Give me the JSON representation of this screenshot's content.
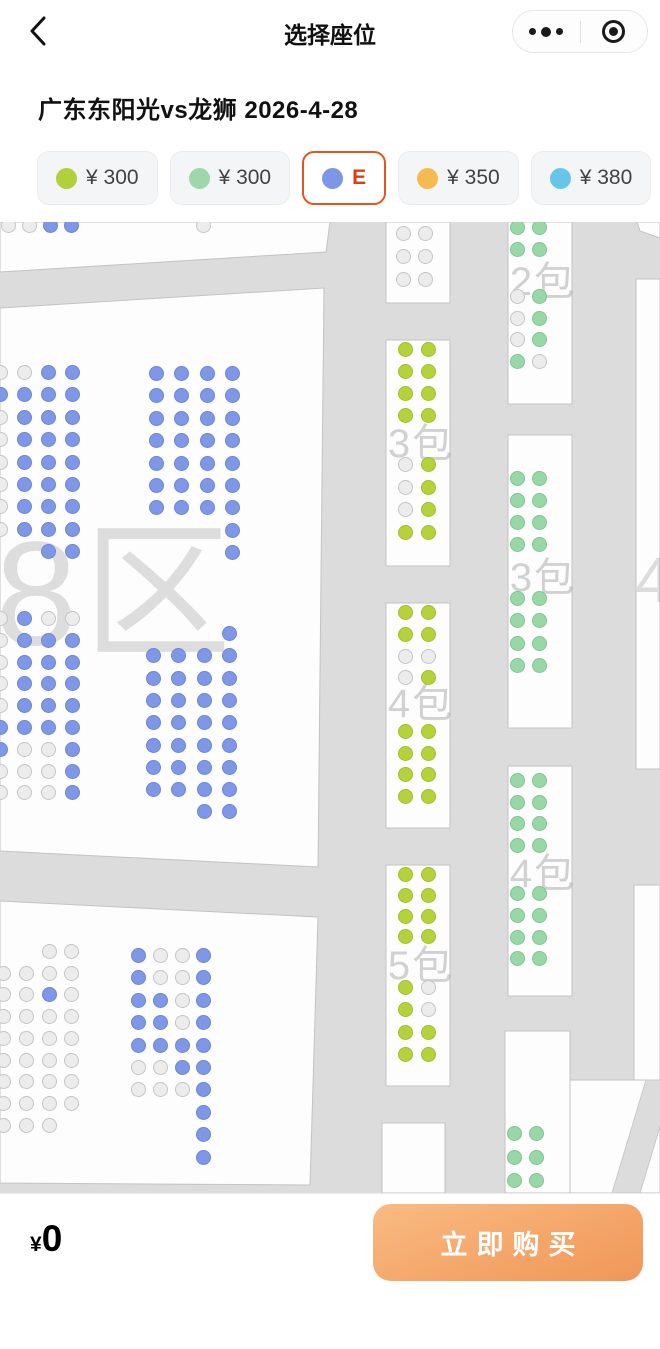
{
  "nav": {
    "title": "选择座位",
    "back_icon": "chevron-left",
    "menu_icon": "more-dots",
    "home_icon": "target-circle"
  },
  "event": {
    "title": "广东东阳光vs龙狮 2026-4-28"
  },
  "filters": {
    "chips": [
      {
        "label": "¥ 300",
        "color": "#b2d03a",
        "selected": false
      },
      {
        "label": "¥ 300",
        "color": "#9ed8aa",
        "selected": false
      },
      {
        "label": "E",
        "color": "#7d97e8",
        "selected": true
      },
      {
        "label": "¥ 350",
        "color": "#f6bb4e",
        "selected": false
      },
      {
        "label": "¥ 380",
        "color": "#66c6ea",
        "selected": false
      },
      {
        "label": "",
        "color": "#f4f5f6",
        "selected": false,
        "stub": true
      }
    ]
  },
  "seat_colors": {
    "B": {
      "fill": "#7e97e7",
      "stroke": "#6d86d3",
      "status": "available-blue"
    },
    "Y": {
      "fill": "#b5d23b",
      "stroke": "#a2bf2d",
      "status": "available-yellowgreen"
    },
    "G": {
      "fill": "#97d8a6",
      "stroke": "#82c492",
      "status": "available-green"
    },
    "g": {
      "fill": "#ececec",
      "stroke": "#c5c5c5",
      "status": "unavailable"
    }
  },
  "map": {
    "colors": {
      "bg": "#dcdcdc",
      "panel": "#fdfdfd",
      "panel_edge": "#c3c3c3",
      "aisle": "#dcdcdc",
      "aisle_edge": "#c9c9c9"
    },
    "panels": [
      {
        "name": "upper-left-stand",
        "points": "0,0 330,0 326,30 0,50"
      },
      {
        "name": "main-left-stand",
        "points": "0,86 324,66 318,645 0,629"
      },
      {
        "name": "lower-left-stand",
        "points": "0,679 318,695 310,963 0,961"
      },
      {
        "name": "top-right-wedge",
        "points": "637,0 660,0 660,16 640,9"
      },
      {
        "name": "right-edge-upper",
        "points": "636,57 660,57 660,547 636,547"
      },
      {
        "name": "right-edge-lower",
        "points": "634,663 660,663 660,971 634,971"
      },
      {
        "name": "bottom-right-stand",
        "points": "566,858 660,858 660,971 566,971"
      },
      {
        "name": "bottom-right-aisle",
        "points": "612,971 646,858 674,858 640,971",
        "fill": "aisle"
      }
    ],
    "boxes": [
      {
        "name": "suite-box-top",
        "x": 386,
        "y": 0,
        "w": 64,
        "h": 81
      },
      {
        "name": "suite-box-3-mid",
        "x": 386,
        "y": 118,
        "w": 64,
        "h": 226
      },
      {
        "name": "suite-box-4-mid",
        "x": 386,
        "y": 381,
        "w": 64,
        "h": 225
      },
      {
        "name": "suite-box-5-mid",
        "x": 386,
        "y": 643,
        "w": 64,
        "h": 221
      },
      {
        "name": "suite-box-empty",
        "x": 382,
        "y": 901,
        "w": 63,
        "h": 70
      },
      {
        "name": "suite-box-2-right",
        "x": 508,
        "y": 0,
        "w": 64,
        "h": 182
      },
      {
        "name": "suite-box-3-right",
        "x": 508,
        "y": 213,
        "w": 64,
        "h": 293
      },
      {
        "name": "suite-box-4-right",
        "x": 508,
        "y": 544,
        "w": 64,
        "h": 230
      },
      {
        "name": "suite-box-bottom",
        "x": 505,
        "y": 809,
        "w": 65,
        "h": 162
      }
    ],
    "watermarks": [
      {
        "text": "08区",
        "x": 72,
        "y": 358,
        "size": 148,
        "big": true
      },
      {
        "text": "3包",
        "x": 421,
        "y": 218,
        "size": 40
      },
      {
        "text": "4包",
        "x": 421,
        "y": 478,
        "size": 40
      },
      {
        "text": "5包",
        "x": 421,
        "y": 740,
        "size": 40
      },
      {
        "text": "2包",
        "x": 543,
        "y": 56,
        "size": 40
      },
      {
        "text": "3包",
        "x": 543,
        "y": 352,
        "size": 40
      },
      {
        "text": "4包",
        "x": 543,
        "y": 648,
        "size": 40
      },
      {
        "text": "4",
        "x": 656,
        "y": 358,
        "size": 64,
        "big": true
      }
    ],
    "seat_blocks": [
      {
        "x": 1,
        "y": -4,
        "px": 21,
        "py": 22,
        "rows": [
          "ggBB"
        ]
      },
      {
        "x": 196,
        "y": -4,
        "px": 21,
        "py": 22,
        "rows": [
          "g"
        ]
      },
      {
        "x": -7,
        "y": 143,
        "px": 24,
        "py": 22.4,
        "rows": [
          "ggBB",
          "BBBB",
          "gBBB",
          "gBBB",
          "gBBB",
          "gBBB",
          "gBBB",
          "gBBB",
          "..BB"
        ]
      },
      {
        "x": 149,
        "y": 144,
        "px": 25.3,
        "py": 22.4,
        "rows": [
          "BBBB",
          "BBBB",
          "BBBB",
          "BBBB",
          "BBBB",
          "BBBB",
          "BBBB",
          "...B",
          "...B"
        ]
      },
      {
        "x": -7,
        "y": 389,
        "px": 24,
        "py": 21.8,
        "rows": [
          "gBgg",
          "gBBB",
          "gBBB",
          "gBBB",
          "gBBB",
          "BBBB",
          "BggB",
          "gggB",
          "gggB"
        ]
      },
      {
        "x": 146,
        "y": 404,
        "px": 25.3,
        "py": 22.3,
        "rows": [
          "...B",
          "BBBB",
          "BBBB",
          "BBBB",
          "BBBB",
          "BBBB",
          "BBBB",
          "BBBB",
          "..BB"
        ]
      },
      {
        "x": -4,
        "y": 722,
        "px": 22.8,
        "py": 21.7,
        "rows": [
          "..gg",
          "gggg",
          "ggBg",
          "gggg",
          "gggg",
          "gggg",
          "gggg",
          "gggg",
          "ggg."
        ]
      },
      {
        "x": 131,
        "y": 726,
        "px": 21.8,
        "py": 22.4,
        "rows": [
          "BggB",
          "BggB",
          "BBgB",
          "BBgB",
          "BBBB",
          "ggBB",
          "gggB",
          "...B",
          "...B",
          "...B"
        ]
      },
      {
        "x": 396,
        "y": 4,
        "px": 22,
        "py": 23,
        "rows": [
          "gg",
          "gg",
          "gg"
        ]
      },
      {
        "x": 398,
        "y": 120,
        "px": 23,
        "py": 22,
        "rows": [
          "YY",
          "YY",
          "YY",
          "YY"
        ]
      },
      {
        "x": 398,
        "y": 235,
        "px": 23,
        "py": 22.6,
        "rows": [
          "gY",
          "gY",
          "gY",
          "YY"
        ]
      },
      {
        "x": 398,
        "y": 383,
        "px": 23,
        "py": 21.8,
        "rows": [
          "YY",
          "YY",
          "gg",
          "gY"
        ]
      },
      {
        "x": 398,
        "y": 502,
        "px": 23,
        "py": 21.6,
        "rows": [
          "YY",
          "YY",
          "YY",
          "YY"
        ]
      },
      {
        "x": 398,
        "y": 645,
        "px": 23,
        "py": 20.8,
        "rows": [
          "YY",
          "YY",
          "YY",
          "YY"
        ]
      },
      {
        "x": 398,
        "y": 758,
        "px": 23,
        "py": 22.4,
        "rows": [
          "Yg",
          "Yg",
          "YY",
          "YY"
        ]
      },
      {
        "x": 510,
        "y": -2,
        "px": 22,
        "py": 22,
        "rows": [
          "GG",
          "GG"
        ]
      },
      {
        "x": 510,
        "y": 67,
        "px": 22,
        "py": 21.7,
        "rows": [
          "gG",
          "gG",
          "gG",
          "Gg"
        ]
      },
      {
        "x": 510,
        "y": 249,
        "px": 22,
        "py": 22,
        "rows": [
          "GG",
          "GG",
          "GG",
          "GG"
        ]
      },
      {
        "x": 510,
        "y": 369,
        "px": 22,
        "py": 22.4,
        "rows": [
          "GG",
          "GG",
          "GG",
          "GG"
        ]
      },
      {
        "x": 510,
        "y": 551,
        "px": 22,
        "py": 21.7,
        "rows": [
          "GG",
          "GG",
          "GG",
          "GG"
        ]
      },
      {
        "x": 510,
        "y": 664,
        "px": 22,
        "py": 21.8,
        "rows": [
          "GG",
          "GG",
          "GG",
          "GG"
        ]
      },
      {
        "x": 507,
        "y": 904,
        "px": 22,
        "py": 23.5,
        "rows": [
          "GG",
          "GG",
          "GG"
        ]
      }
    ]
  },
  "footer": {
    "currency": "¥",
    "total": "0",
    "buy_label": "立即购买"
  }
}
